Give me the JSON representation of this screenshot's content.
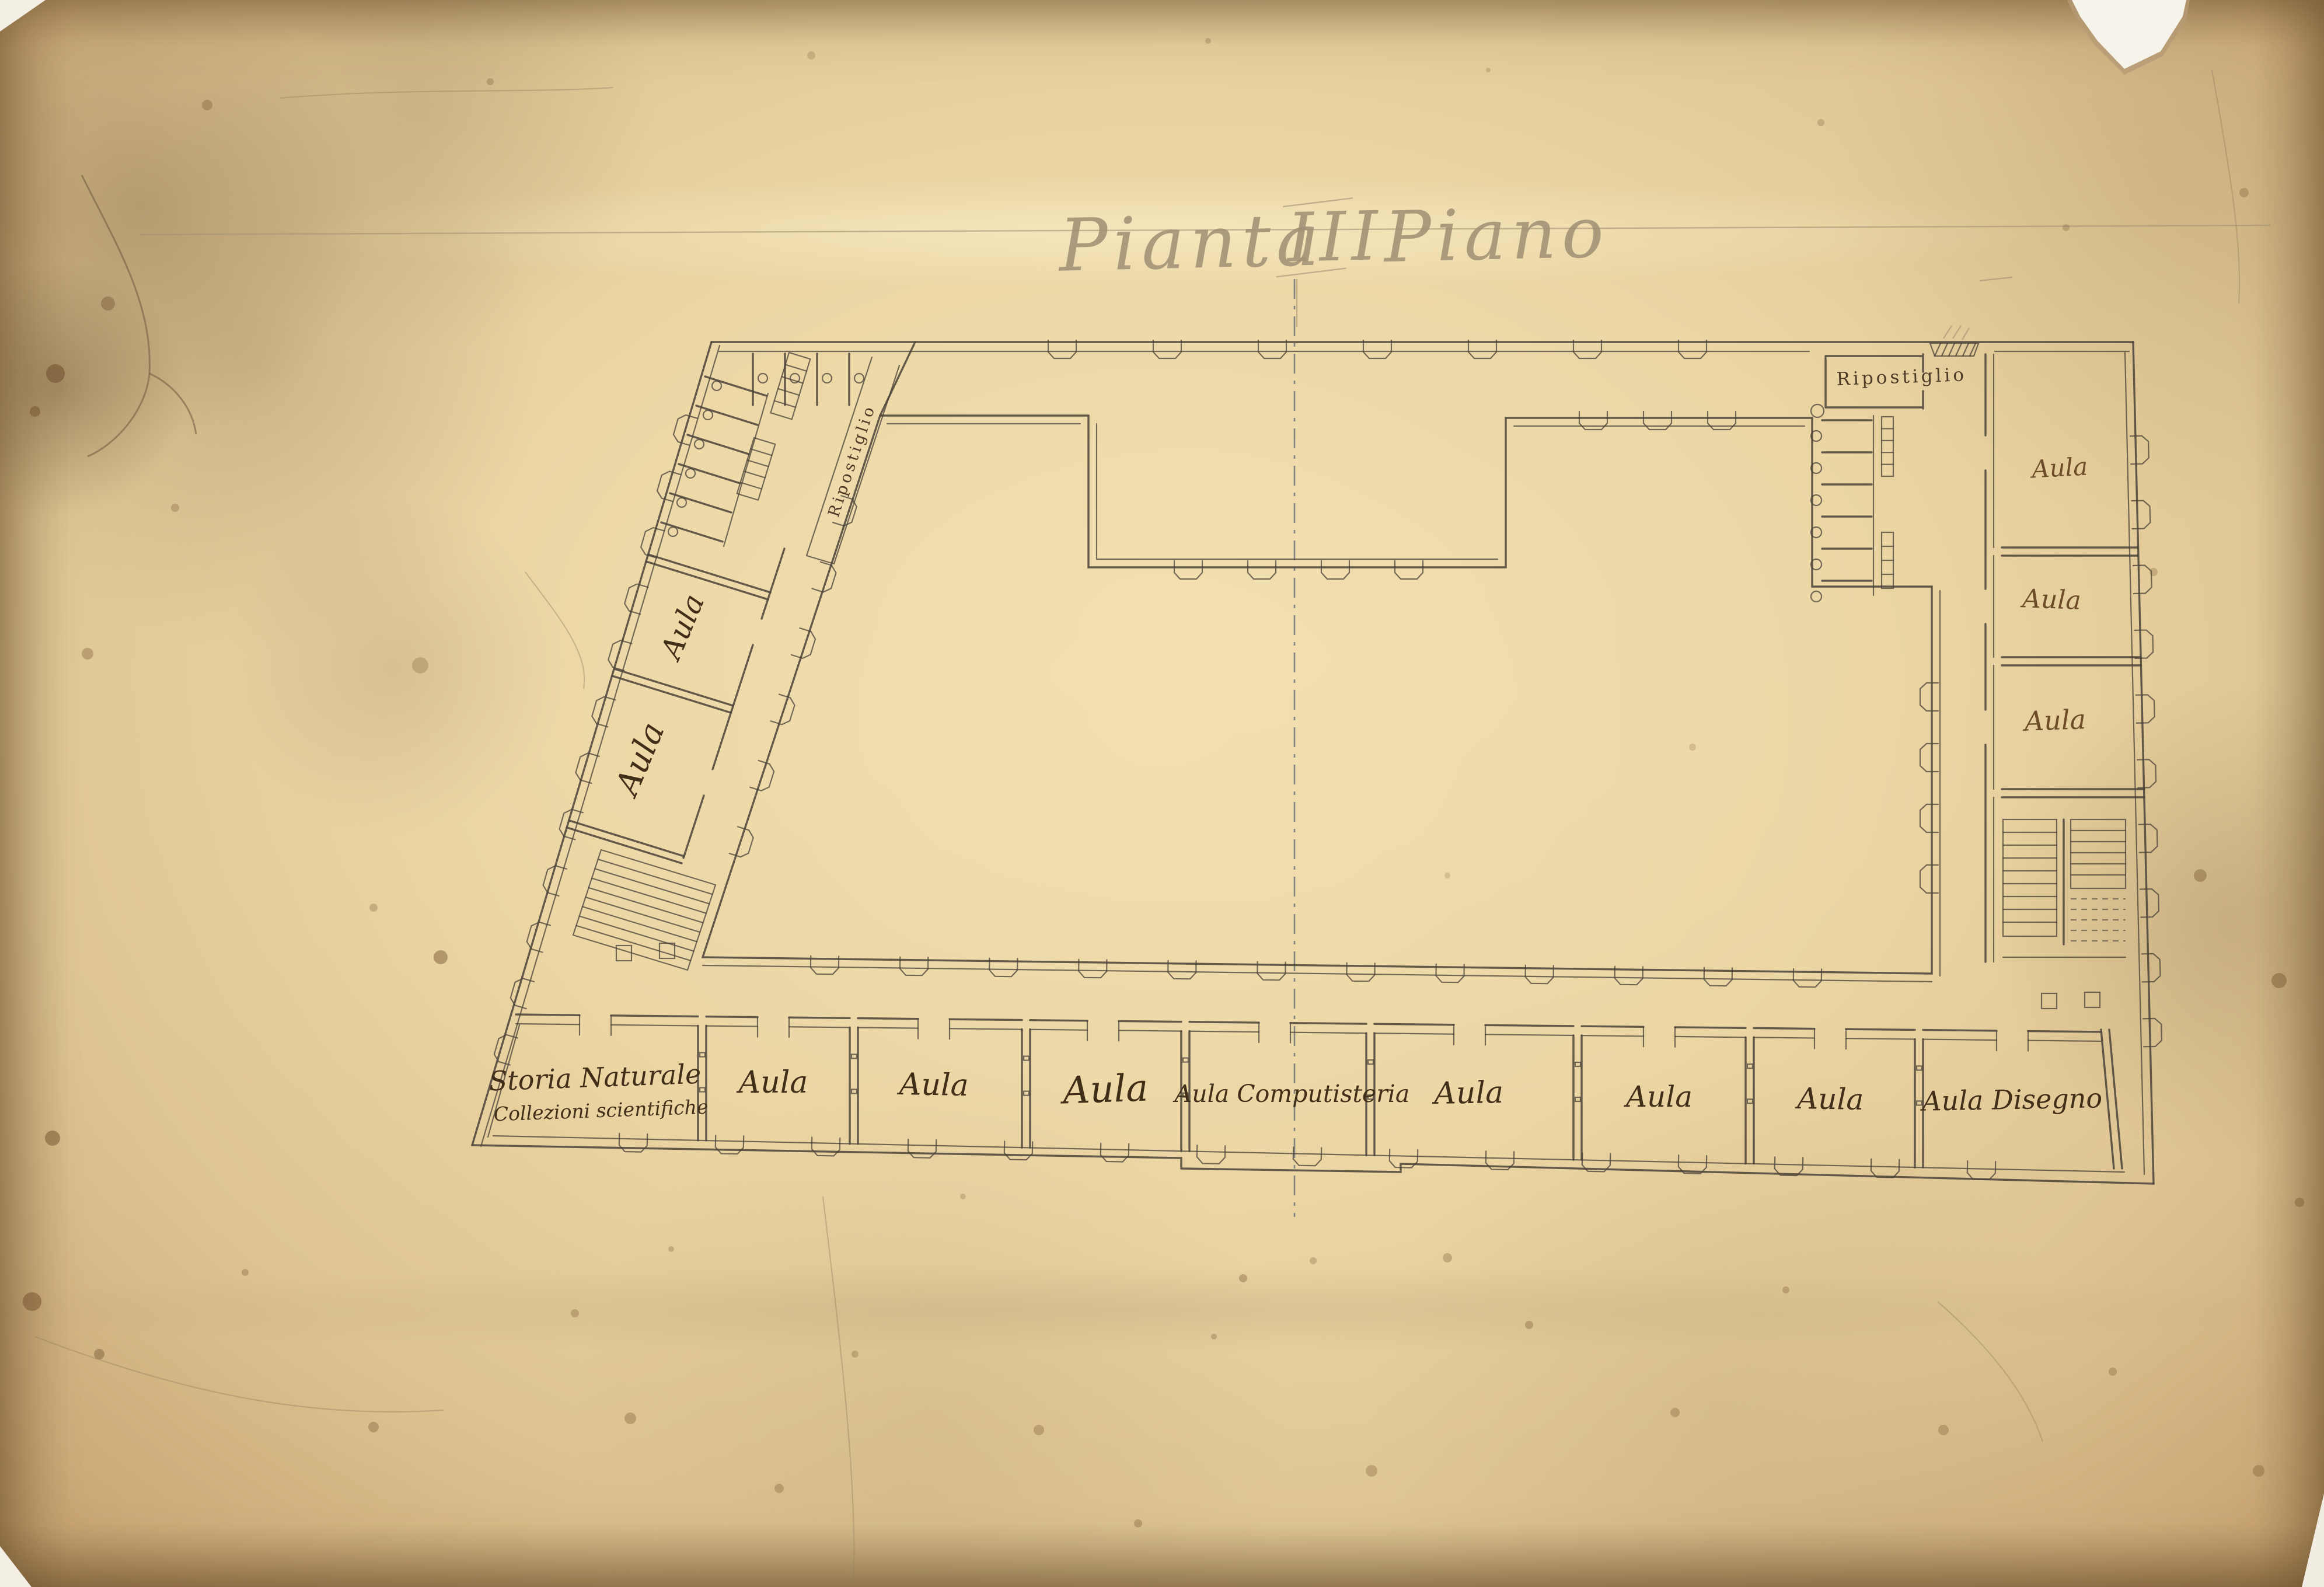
{
  "title": {
    "word1": "Pianta",
    "numeral": "III",
    "word2": "Piano"
  },
  "labels": {
    "left_wing": {
      "ripostiglio": "Ripostiglio",
      "aula_upper": "Aula",
      "aula_lower": "Aula"
    },
    "top_right": {
      "ripostiglio": "Ripostiglio"
    },
    "right_wing": {
      "aula_1": "Aula",
      "aula_2": "Aula",
      "aula_3": "Aula"
    },
    "bottom_row": {
      "storia_line1": "Storia Naturale",
      "storia_line2": "Collezioni scientifiche",
      "aula_1": "Aula",
      "aula_2": "Aula",
      "aula_3": "Aula",
      "computisteria": "Aula Computisteria",
      "aula_4": "Aula",
      "aula_5": "Aula",
      "aula_6": "Aula",
      "disegno": "Aula Disegno"
    }
  },
  "colors": {
    "ink": "#4a4238",
    "label_ink": "#402e18",
    "pencil": "#a29175",
    "centerline": "#5f6672",
    "paper": "#e8d2a1"
  }
}
